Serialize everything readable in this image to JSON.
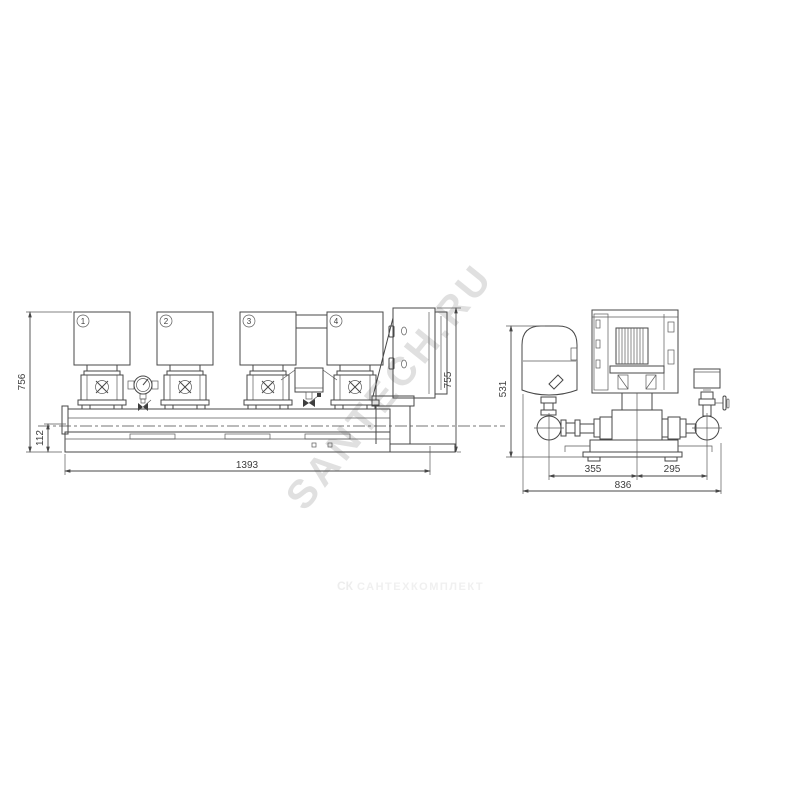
{
  "watermarks": {
    "diagonal": "SANTECH.RU",
    "footer_logo": "СК",
    "footer_text": "САНТЕХКОМПЛЕКТ"
  },
  "front_view": {
    "pump_labels": [
      "1",
      "2",
      "3",
      "4"
    ],
    "dims": {
      "height_left": "756",
      "base_height": "112",
      "width": "1393",
      "height_right": "755"
    }
  },
  "side_view": {
    "dims": {
      "height": "531",
      "span_left": "355",
      "span_right": "295",
      "width": "836"
    }
  },
  "colors": {
    "line": "#474747",
    "dim_text": "#3d3d3d",
    "watermark_diagonal": "#d9d9d9",
    "watermark_footer": "#f0f0f0"
  }
}
